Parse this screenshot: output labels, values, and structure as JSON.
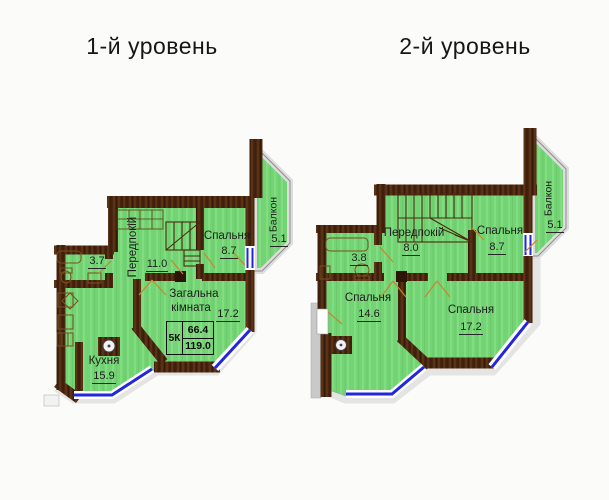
{
  "titles": {
    "level1": "1-й уровень",
    "level2": "2-й уровень"
  },
  "level1": {
    "hall": {
      "name": "Передпокій",
      "area": "11.0"
    },
    "bedroom": {
      "name": "Спальня",
      "area": "8.7"
    },
    "balcony": {
      "name": "Балкон",
      "area": "5.1"
    },
    "living_room": {
      "name_line1": "Загальна",
      "name_line2": "кімната",
      "area": "17.2"
    },
    "kitchen": {
      "name": "Кухня",
      "area": "15.9"
    },
    "bathroom": {
      "area": "3.7"
    },
    "stamp": {
      "rooms_code": "5К",
      "living_area": "66.4",
      "total_area": "119.0"
    }
  },
  "level2": {
    "hall": {
      "name": "Передпокій",
      "area": "8.0"
    },
    "bedroom_top": {
      "name": "Спальня",
      "area": "8.7"
    },
    "balcony": {
      "name": "Балкон",
      "area": "5.1"
    },
    "bedroom_left": {
      "name": "Спальня",
      "area": "14.6"
    },
    "bedroom_right": {
      "name": "Спальня",
      "area": "17.2"
    },
    "bathroom": {
      "area": "3.8"
    }
  },
  "colors": {
    "room_fill": "#74d374",
    "wall_brown": "#4a2610",
    "window_blue": "#2326dd",
    "balcony_band": "#dddddd",
    "door_line": "#c6872f",
    "text": "#1d1d1d"
  }
}
